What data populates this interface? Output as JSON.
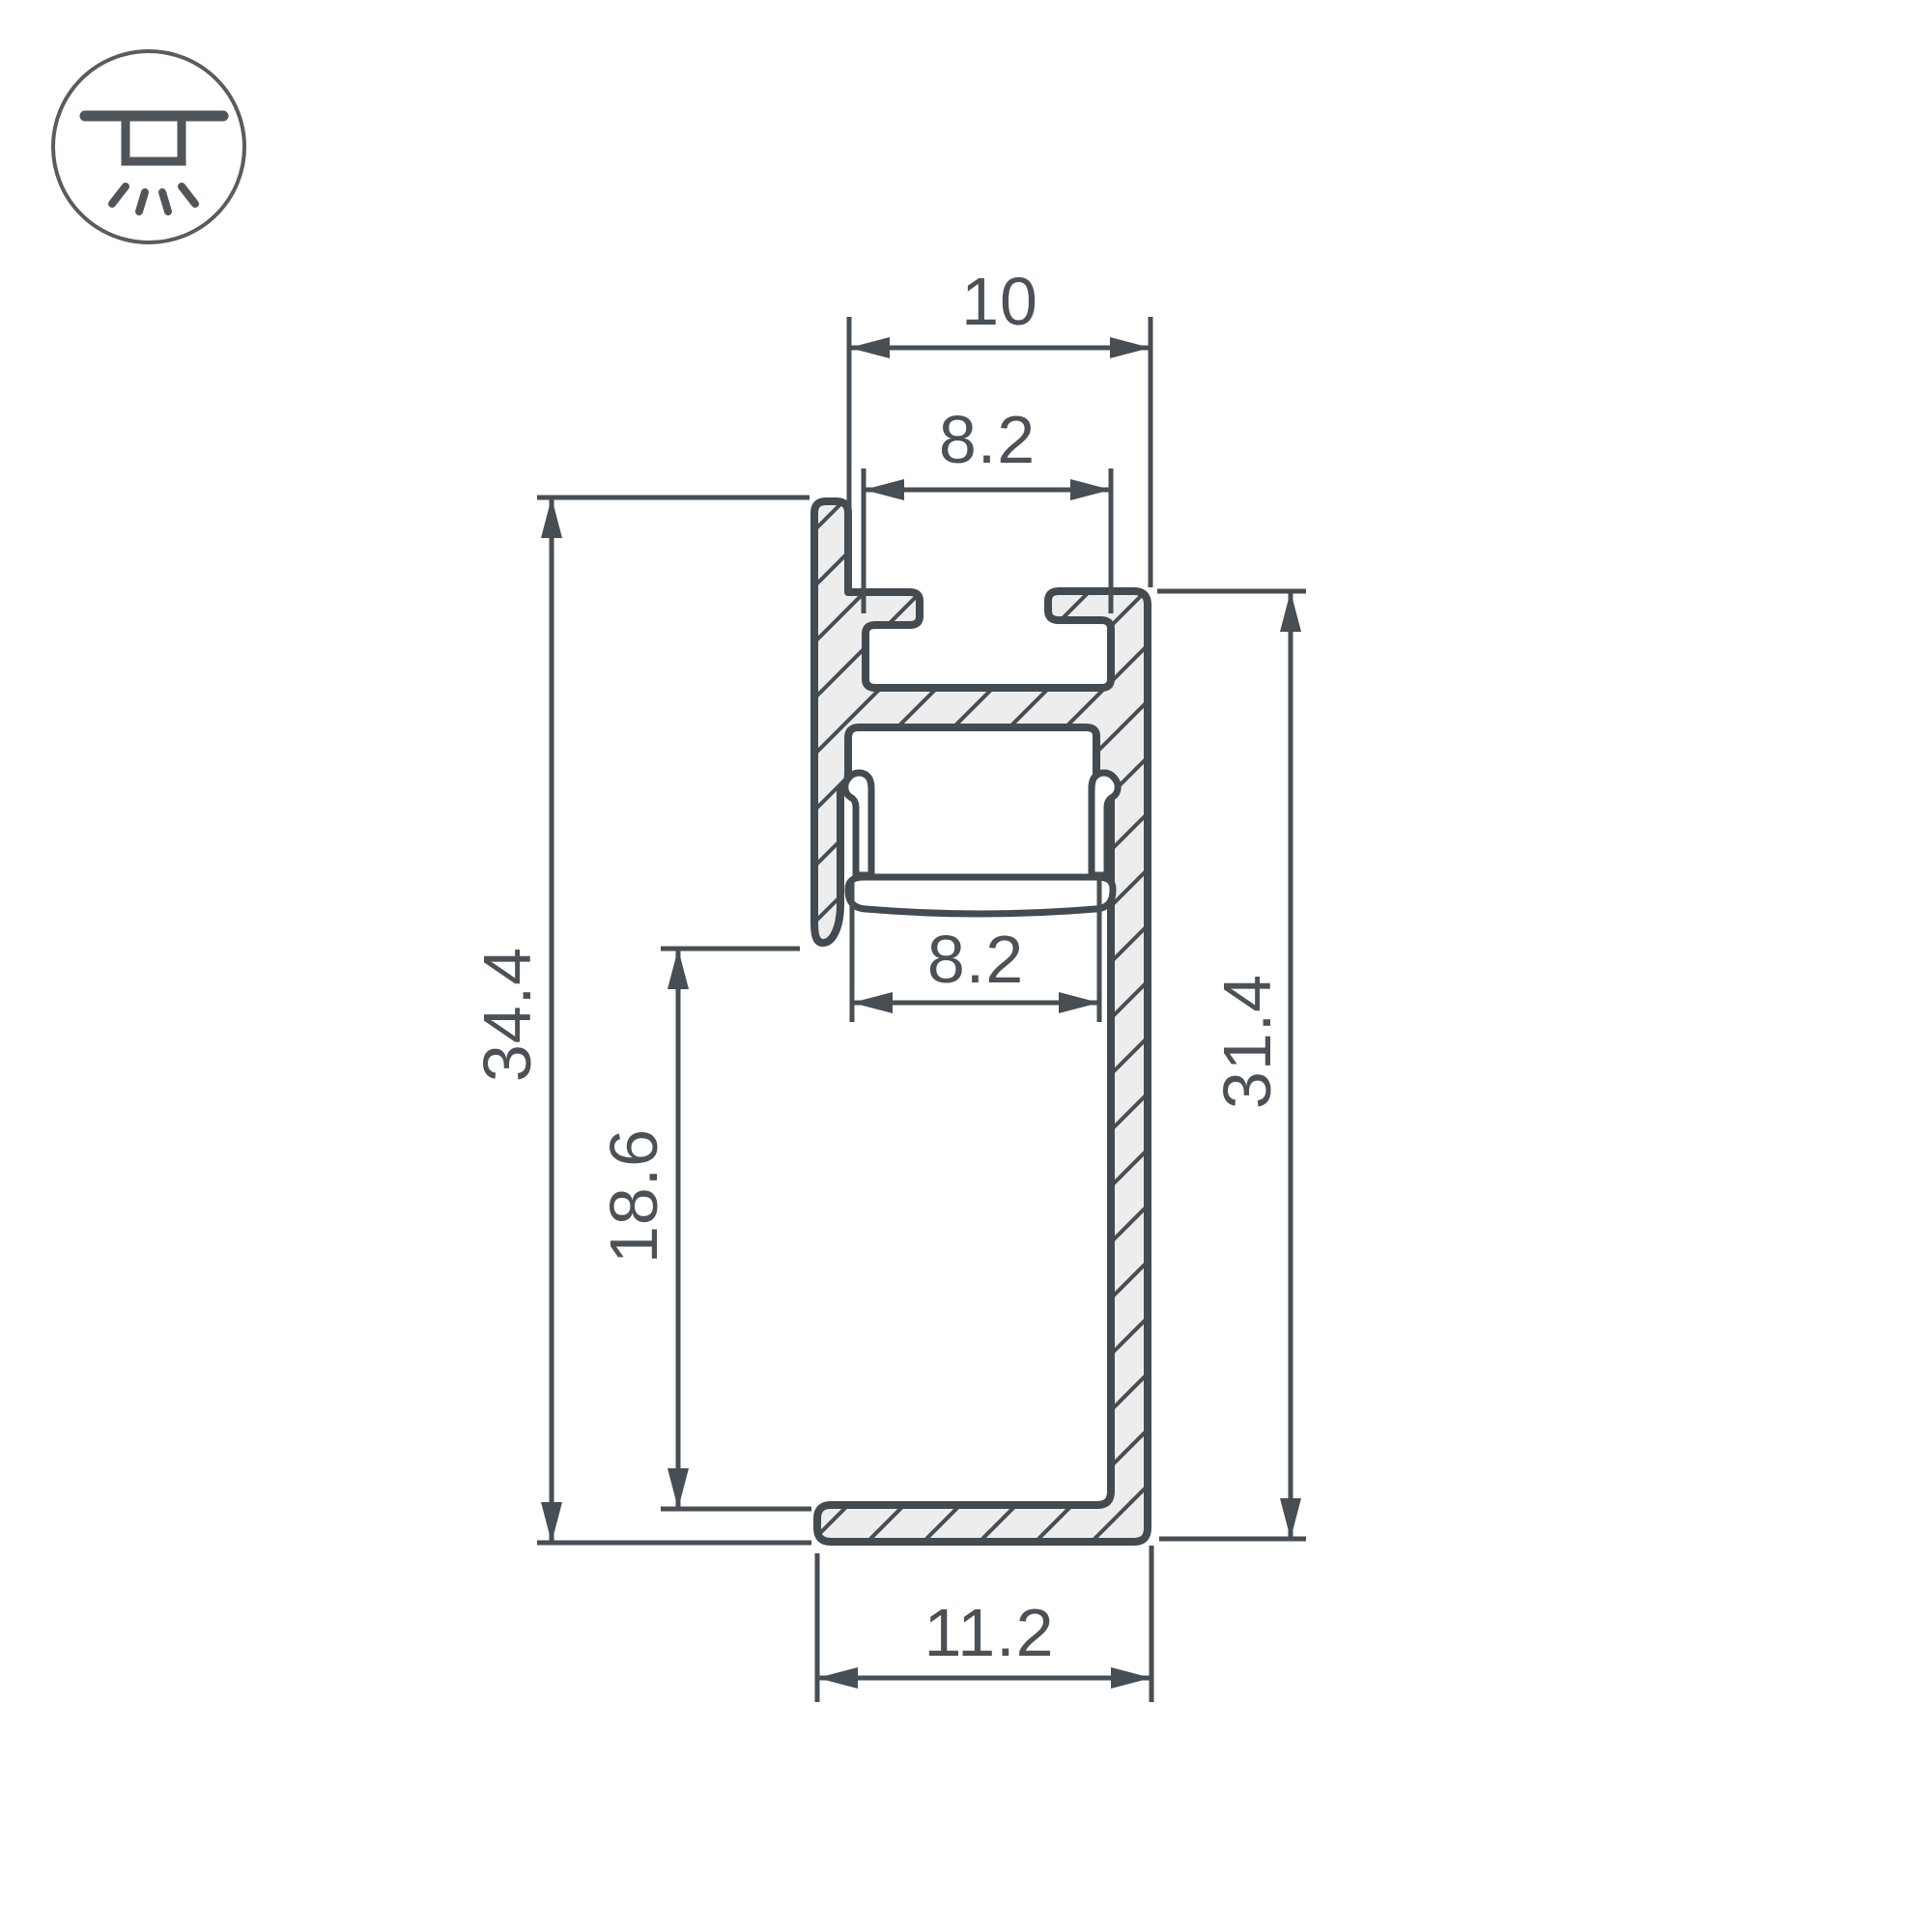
{
  "drawing": {
    "kind": "profile-cross-section",
    "units_shown": false,
    "colors": {
      "line": "#474e54",
      "outline": "#434a50",
      "fill": "#ededee",
      "text": "#4b5156"
    },
    "icon": {
      "name": "recessed-ceiling-light-icon"
    },
    "dimensions": {
      "top_outer_width": "10",
      "top_slot_inner_width": "8.2",
      "diffuser_slot_width": "8.2",
      "overall_height": "34.4",
      "flange_to_base_height": "18.6",
      "wall_height": "31.4",
      "base_width": "11.2"
    }
  }
}
